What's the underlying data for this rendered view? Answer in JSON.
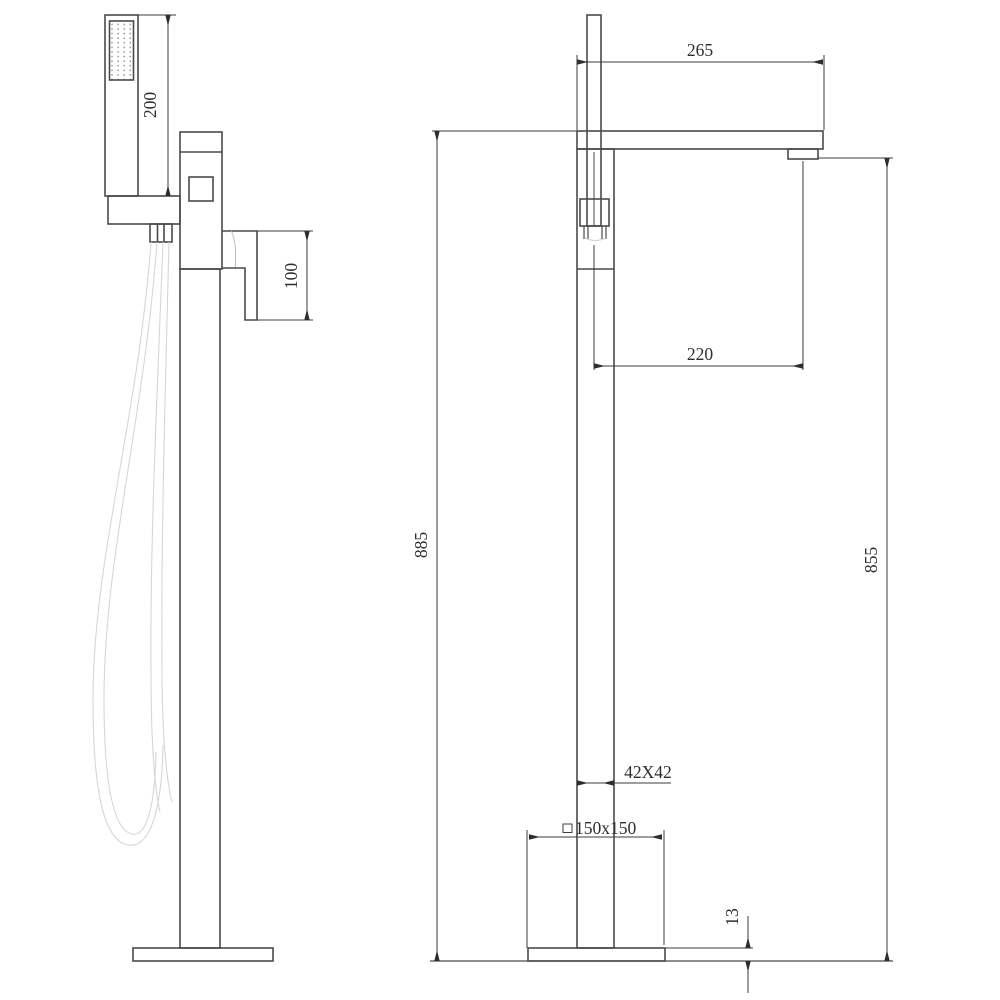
{
  "drawing": {
    "type": "technical-dimension-drawing",
    "subject": "freestanding bathtub faucet with hand shower, two orthographic views",
    "colors": {
      "object_line": "#4a4a4a",
      "dimension_line": "#3d3d3d",
      "hose_line": "#d6d6d6",
      "background": "#ffffff"
    }
  },
  "side_view": {
    "dims": {
      "handshower_length": "200",
      "handle_height": "100"
    }
  },
  "front_view": {
    "dims": {
      "spout_reach": "265",
      "handshower_to_spout": "220",
      "overall_height": "885",
      "spout_outlet_height": "855",
      "column_section": "42X42",
      "base_plate": "150x150",
      "base_thickness": "13"
    }
  }
}
